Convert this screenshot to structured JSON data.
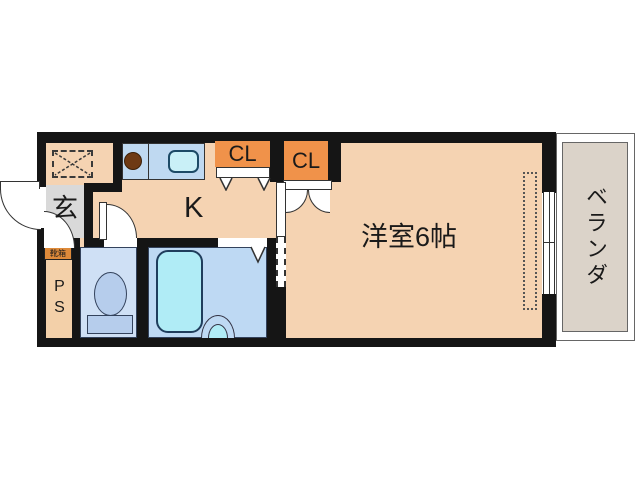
{
  "labels": {
    "genkan": "玄",
    "kitchen": "K",
    "closet_left": "CL",
    "closet_right": "CL",
    "western_room": "洋室6帖",
    "balcony": "ベランダ",
    "pipe_space": "PS",
    "shoe_box": "靴箱"
  },
  "colors": {
    "wall": "#151515",
    "floor": "#f5d3b2",
    "closet": "#f0924a",
    "entrance_floor": "#d9d9d9",
    "toilet_room": "#cfe0f5",
    "toilet_fixture": "#b6cdec",
    "bathroom": "#bed9f3",
    "bathtub": "#b0ecf6",
    "kitchen_counter": "#bfd9f1",
    "kitchen_sink": "#c9f0f7",
    "stove_burner": "#6e3a14",
    "balcony_floor": "#dbd3c9",
    "pipe_space_box": "#f3d0a9",
    "shoe_box": "#de8a3a"
  }
}
